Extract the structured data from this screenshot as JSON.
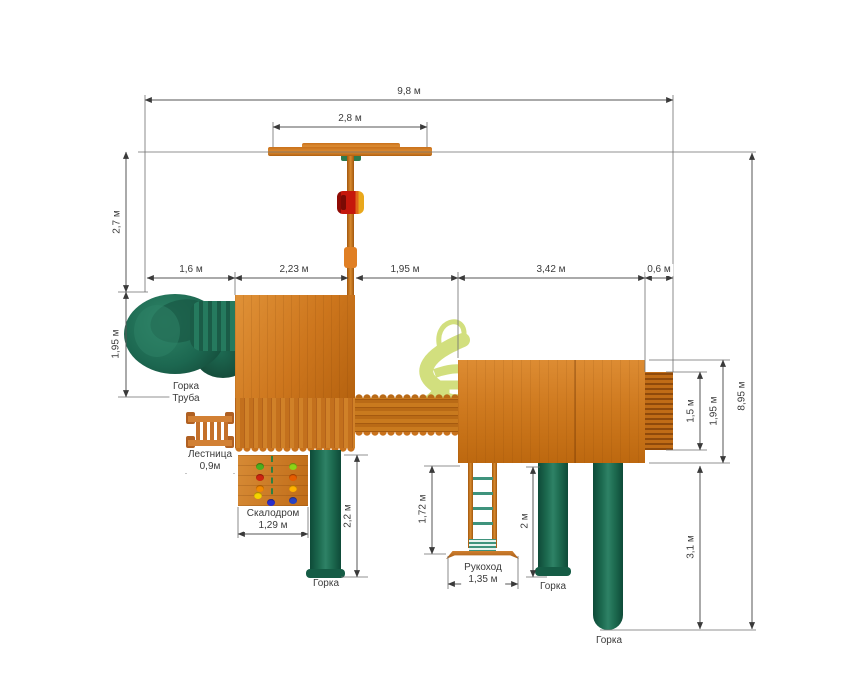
{
  "drawing": {
    "kind": "playground top-view plan",
    "colors": {
      "wood": "#cd761d",
      "wood_dark": "#a55a10",
      "plastic_green": "#1d6b50",
      "plastic_green_dark": "#0e4a38",
      "swing_seat_red": "#c5170b",
      "swing_seat_yellow": "#e9a81c",
      "rung_green": "#3f937c",
      "watermark_green": "#c8d85f",
      "dim_line": "#565656",
      "text": "#3b3b3b",
      "background": "#ffffff"
    },
    "hold_colors": [
      "#49b01e",
      "#cf2410",
      "#f28a00",
      "#f5d400",
      "#2a2ecc",
      "#8cd416",
      "#e65c00",
      "#ffb300",
      "#2743c4"
    ]
  },
  "dims": {
    "total_width": "9,8 м",
    "swing_beam": "2,8 м",
    "swing_offset": "2,7 м",
    "seg_tube": "1,6 м",
    "seg_tower": "2,23 м",
    "seg_gap": "1,95 м",
    "seg_platform": "3,42 м",
    "seg_exit": "0,6 м",
    "tube_depth": "1,95 м",
    "slide1_len": "2,2 м",
    "monkey_len": "1,72 м",
    "monkey_width": "1,35 м",
    "slide2_len": "2 м",
    "exit_width": "1,5 м",
    "platform_depth": "1,95 м",
    "total_depth": "8,95 м",
    "slide3_len": "3,1 м",
    "ladder_width": "0,9м",
    "wall_width": "1,29 м"
  },
  "labels": {
    "tube_slide_line1": "Горка",
    "tube_slide_line2": "Труба",
    "ladder": "Лестница",
    "climb_wall": "Скалодром",
    "monkey_bars": "Рукоход",
    "slide1": "Горка",
    "slide2": "Горка",
    "slide3": "Горка"
  }
}
